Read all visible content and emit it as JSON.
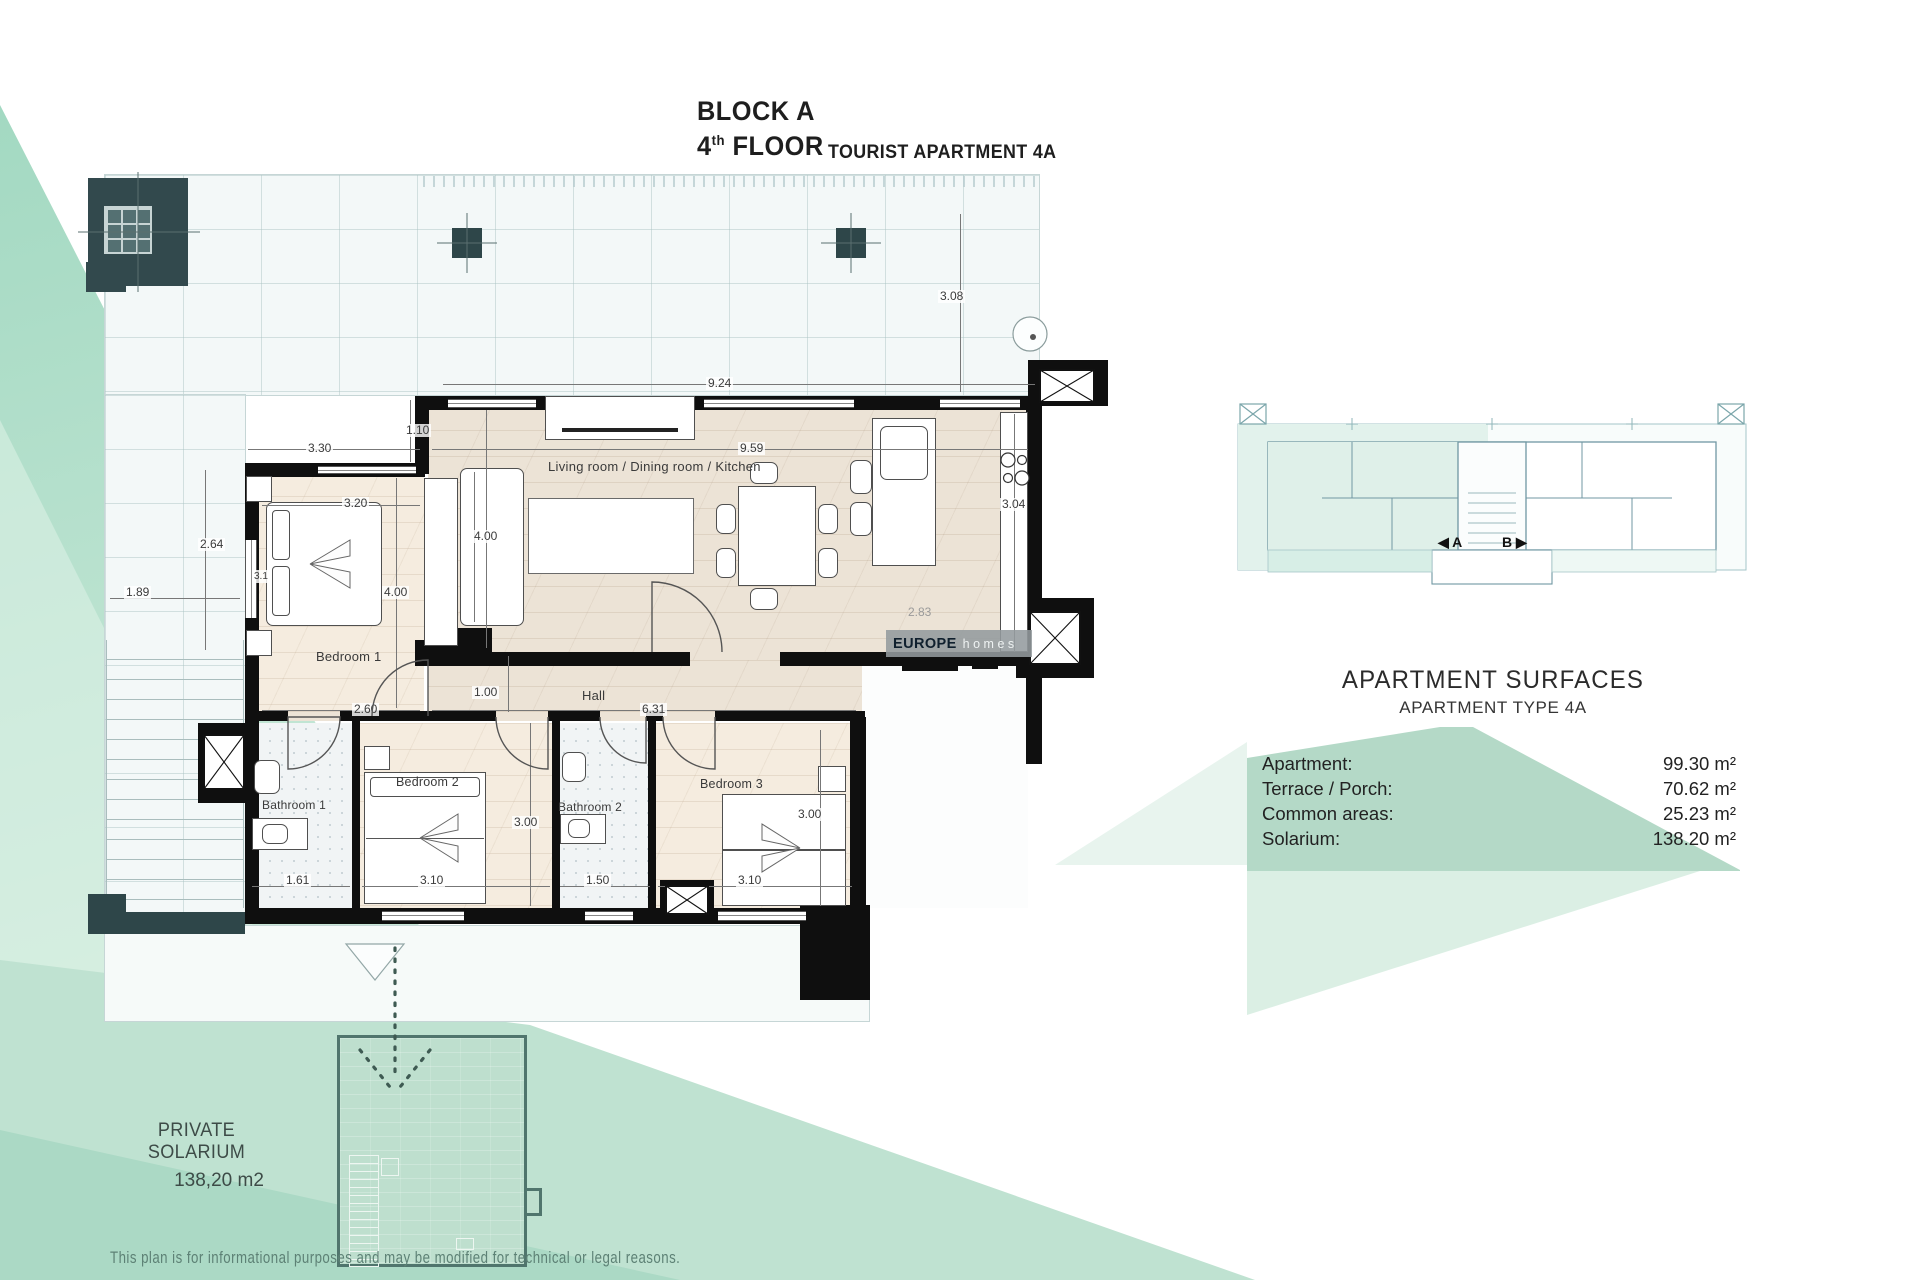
{
  "title": {
    "block": "BLOCK A",
    "floor_number": "4",
    "floor_ordinal": "th",
    "floor_word": "FLOOR",
    "apartment": "TOURIST APARTMENT 4A"
  },
  "plan": {
    "rooms": {
      "living": "Living room / Dining room / Kitchen",
      "bedroom1": "Bedroom 1",
      "hall": "Hall",
      "bathroom1": "Bathroom 1",
      "bedroom2": "Bedroom 2",
      "bathroom2": "Bathroom 2",
      "bedroom3": "Bedroom 3"
    },
    "dims": [
      "9.24",
      "3.08",
      "3.30",
      "9.59",
      "1.10",
      "3.20",
      "2.64",
      "1.89",
      "4.00",
      "4.00",
      "3.1",
      "2.60",
      "1.00",
      "6.31",
      "3.00",
      "1.61",
      "3.10",
      "1.50",
      "3.00",
      "3.10",
      "3.04",
      "2.83"
    ]
  },
  "solarium": {
    "label": "PRIVATE SOLARIUM",
    "area": "138,20 m2"
  },
  "logo": {
    "bold": "EUROPE",
    "light": "homes"
  },
  "overview": {
    "label_a": "◀ A",
    "label_b": "B ▶"
  },
  "surfaces": {
    "title": "APARTMENT SURFACES",
    "subtitle": "APARTMENT TYPE 4A",
    "rows": [
      {
        "label": "Apartment:",
        "value": "99.30 m²"
      },
      {
        "label": "Terrace / Porch:",
        "value": "70.62 m²"
      },
      {
        "label": "Common areas:",
        "value": "25.23 m²"
      },
      {
        "label": "Solarium:",
        "value": "138.20 m²"
      }
    ]
  },
  "disclaimer": "This plan is for informational purposes and may be modified for technical or legal reasons.",
  "colors": {
    "mint": "#bfe2d1",
    "band": "#b4d9c7",
    "wall": "#0f0f0f",
    "wood": "#ece3d6",
    "dark_teal": "#2e4649"
  }
}
